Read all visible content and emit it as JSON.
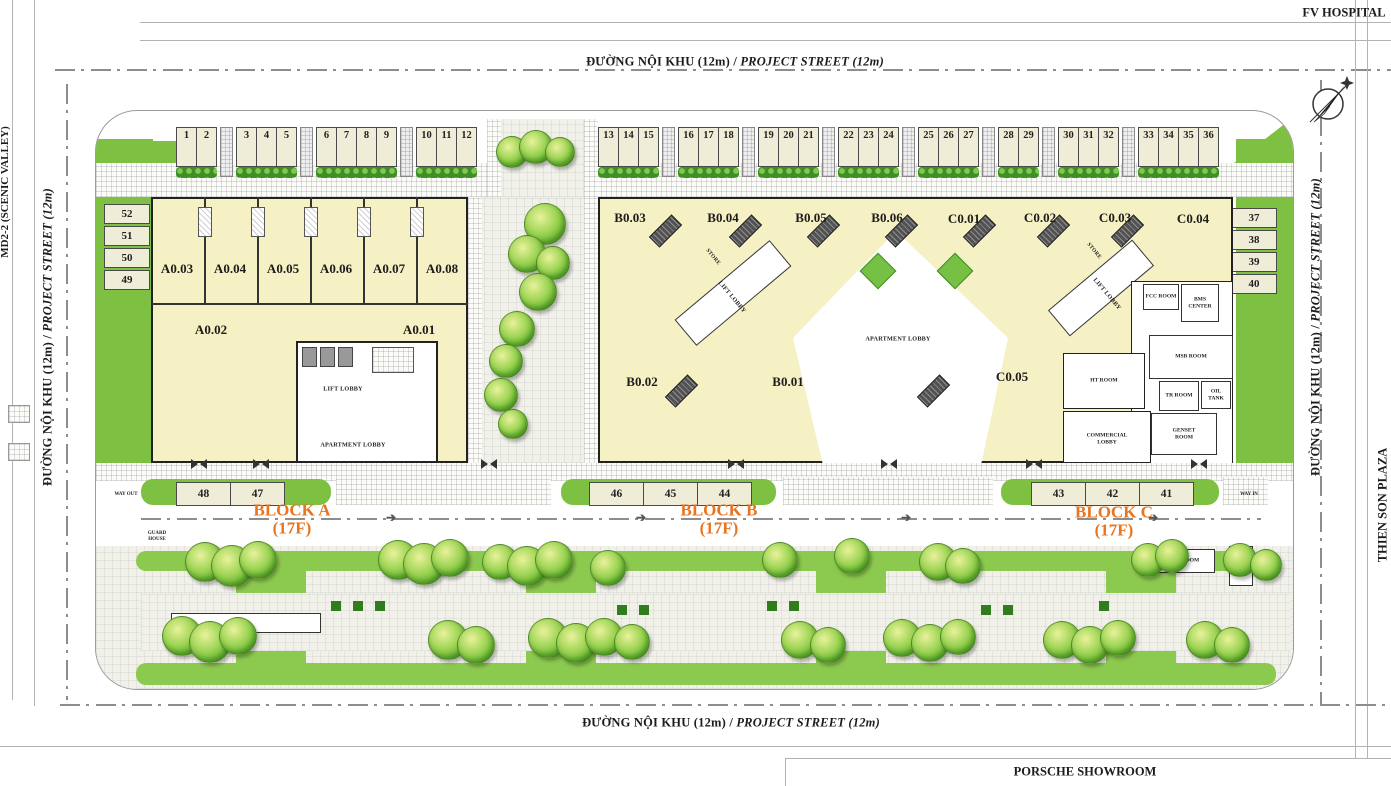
{
  "streets": {
    "vn": "ĐƯỜNG NỘI KHU (12m) /",
    "en": "PROJECT STREET (12m)"
  },
  "neighbors": {
    "top": "FV HOSPITAL",
    "right": "THIEN SON PLAZA",
    "bottom": "PORSCHE SHOWROOM",
    "left": "MD2-2 (SCENIC VALLEY)"
  },
  "parking": {
    "top_left_groups": [
      [
        "1",
        "2"
      ],
      [
        "3",
        "4",
        "5"
      ],
      [
        "6",
        "7",
        "8",
        "9"
      ],
      [
        "10",
        "11",
        "12"
      ]
    ],
    "top_right_groups": [
      [
        "13",
        "14",
        "15"
      ],
      [
        "16",
        "17",
        "18"
      ],
      [
        "19",
        "20",
        "21"
      ],
      [
        "22",
        "23",
        "24"
      ],
      [
        "25",
        "26",
        "27"
      ],
      [
        "28",
        "29"
      ],
      [
        "30",
        "31",
        "32"
      ],
      [
        "33",
        "34",
        "35",
        "36"
      ]
    ],
    "left_col": [
      "52",
      "51",
      "50",
      "49"
    ],
    "right_col": [
      "37",
      "38",
      "39",
      "40"
    ],
    "bottom_a": [
      "48",
      "47"
    ],
    "bottom_b": [
      "46",
      "45",
      "44"
    ],
    "bottom_c": [
      "43",
      "42",
      "41"
    ]
  },
  "blocks": {
    "a": {
      "name": "BLOCK A",
      "floors": "(17F)"
    },
    "b": {
      "name": "BLOCK B",
      "floors": "(17F)"
    },
    "c": {
      "name": "BLOCK C",
      "floors": "(17F)"
    }
  },
  "units": {
    "a_row": [
      "A0.03",
      "A0.04",
      "A0.05",
      "A0.06",
      "A0.07",
      "A0.08"
    ],
    "a_low": [
      "A0.02",
      "A0.01"
    ],
    "bc_row": [
      "B0.03",
      "B0.04",
      "B0.05",
      "B0.06",
      "C0.01",
      "C0.02",
      "C0.03",
      "C0.04"
    ],
    "bc_low": [
      "B0.02",
      "B0.01",
      "C0.05"
    ]
  },
  "rooms": {
    "lift_lobby": "LIFT LOBBY",
    "apartment_lobby": "APARTMENT LOBBY",
    "store": "STORE",
    "fcc": "FCC ROOM",
    "bms": "BMS CENTER",
    "msb": "MSB ROOM",
    "tr": "TR ROOM",
    "oil": "OIL TANK",
    "genset": "GENSET ROOM",
    "ht": "HT ROOM",
    "commercial": "COMMERCIAL LOBBY",
    "gas": "GAS ROOM",
    "guard": "GUARD HOUSE"
  },
  "wayfinding": {
    "way_in": "WAY IN",
    "way_out": "WAY OUT"
  },
  "icons": {
    "arrow": "➔"
  }
}
